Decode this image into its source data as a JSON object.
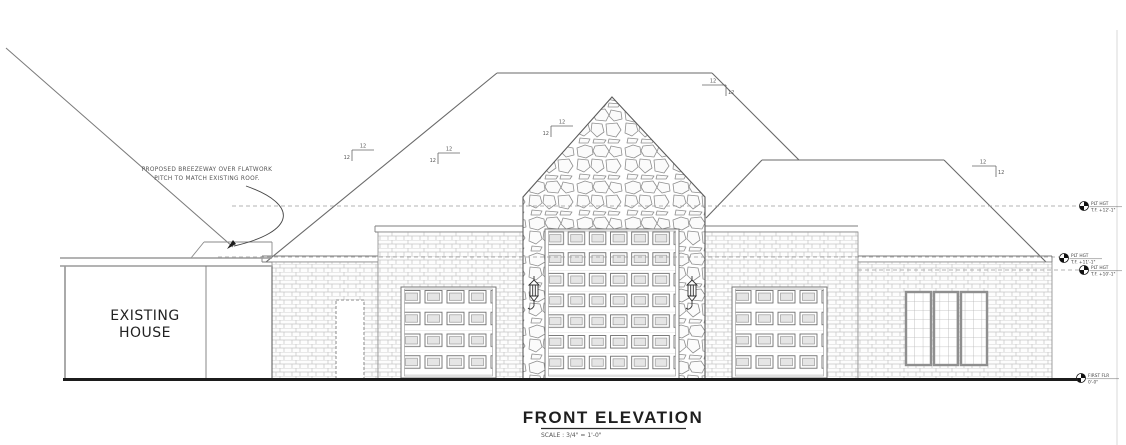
{
  "title": {
    "text": "FRONT ELEVATION",
    "scale": "SCALE : 3/4\" = 1'-0\""
  },
  "existing_house": {
    "label_line1": "EXISTING",
    "label_line2": "HOUSE"
  },
  "breezeway_note": {
    "line1": "PROPOSED BREEZEWAY OVER FLATWORK",
    "line2": "PITCH TO MATCH EXISTING ROOF."
  },
  "pitch_markers": [
    {
      "run": "12",
      "rise": "12"
    },
    {
      "run": "12",
      "rise": "12"
    },
    {
      "run": "12",
      "rise": "12"
    },
    {
      "run": "12",
      "rise": "12"
    },
    {
      "run": "12",
      "rise": "12"
    }
  ],
  "elevation_markers": [
    {
      "label": "PLT HGT",
      "value": "T.F. +12'-1\""
    },
    {
      "label": "PLT HGT",
      "value": "T.F. +11'-1\""
    },
    {
      "label": "PLT HGT",
      "value": "T.F. +10'-1\""
    },
    {
      "label": "FIRST FLR",
      "value": "0'-0\""
    }
  ],
  "colors": {
    "line": "#666666",
    "dark_line": "#1c1c1c",
    "mortar": "#c8c8c8",
    "panel_fill": "#e5e5e5",
    "background": "#ffffff"
  }
}
